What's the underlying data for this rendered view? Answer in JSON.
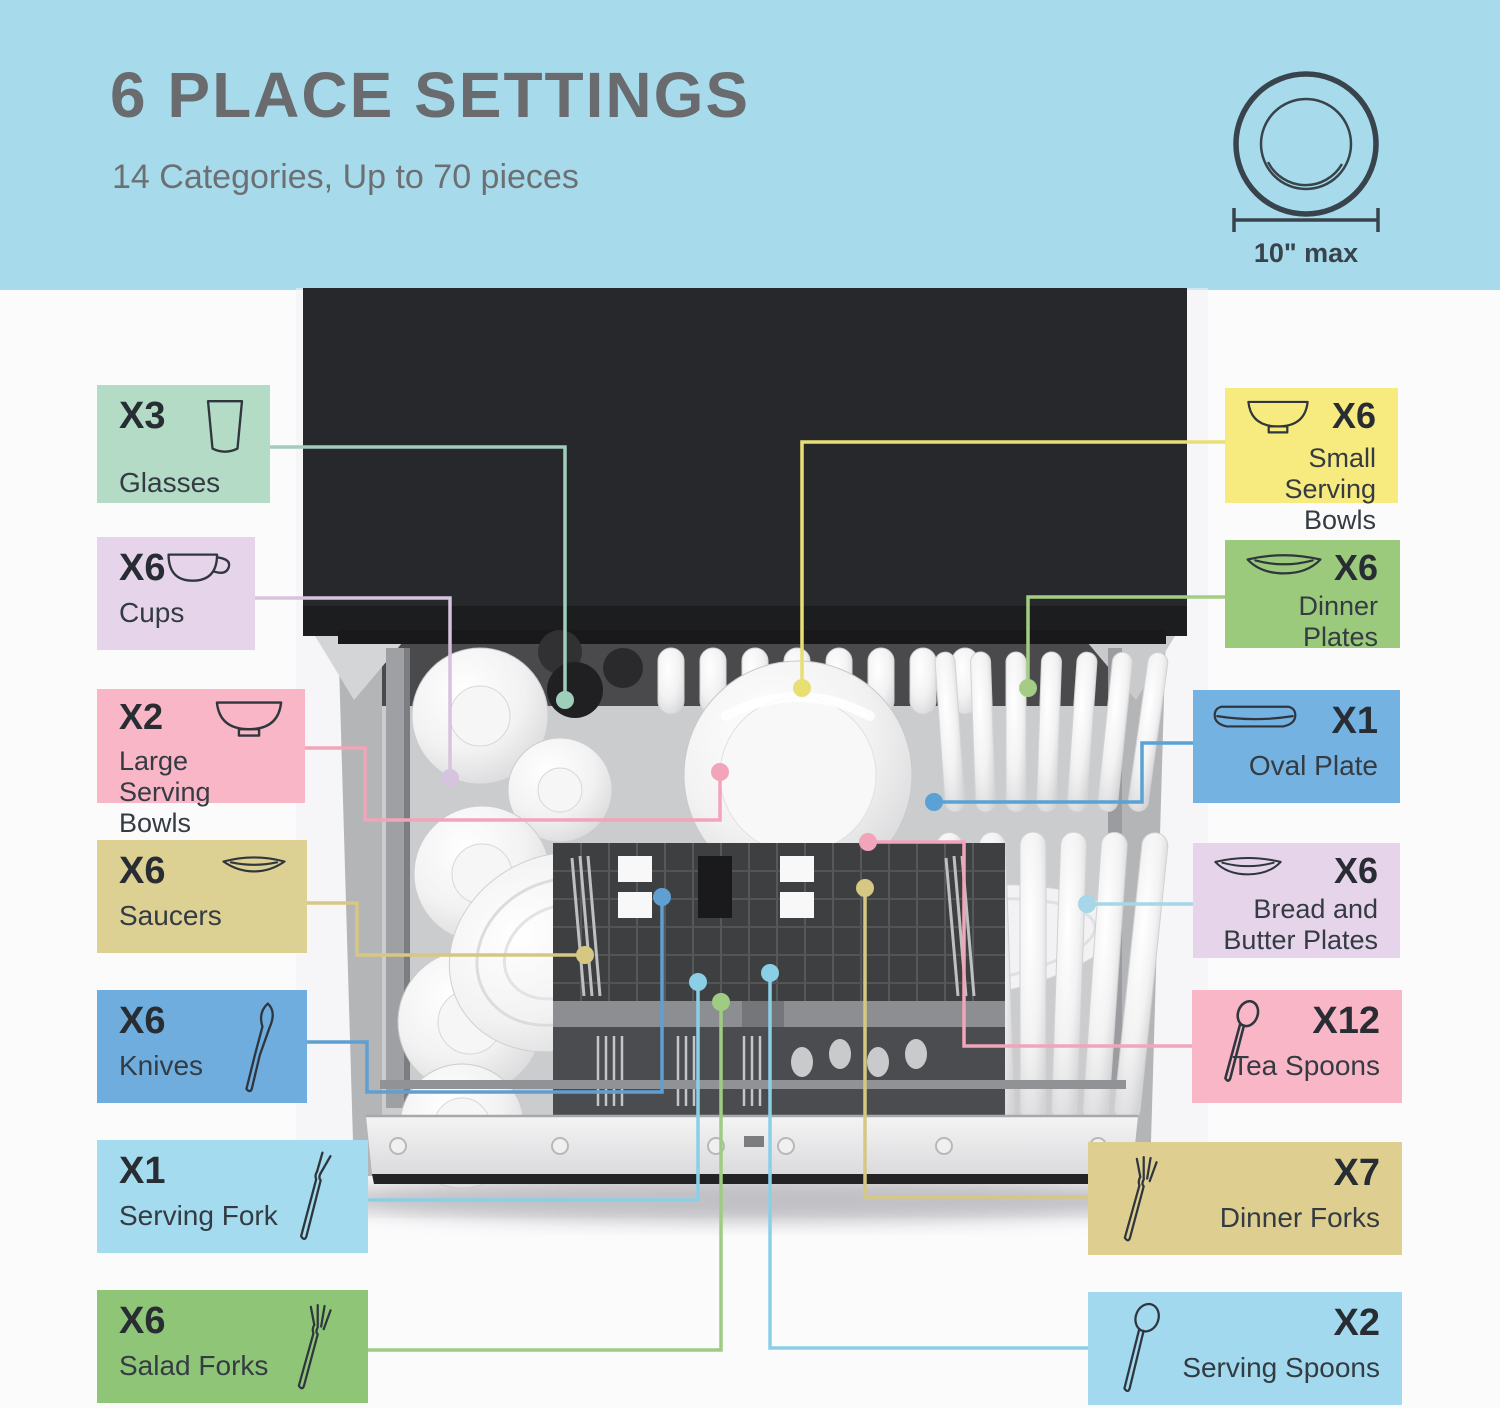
{
  "header": {
    "title": "6 PLACE SETTINGS",
    "subtitle": "14 Categories, Up to 70 pieces",
    "plate_limit": "10\" max"
  },
  "colors": {
    "header_bg": "#a7dbec",
    "header_text": "#696b6e",
    "badge_stroke": "#39434b",
    "icon_stroke": "#2f363d",
    "door_panel": "#27282b"
  },
  "categories": {
    "left": [
      {
        "count": "X3",
        "name": "Glasses",
        "icon": "glass-icon",
        "bg": "#b3dbc6",
        "line": "#9fceba"
      },
      {
        "count": "X6",
        "name": "Cups",
        "icon": "cup-icon",
        "bg": "#e6d4eb",
        "line": "#d6c3de"
      },
      {
        "count": "X2",
        "name": "Large\nServing Bowls",
        "icon": "bowl-icon",
        "bg": "#f8b6c6",
        "line": "#f2a4ba"
      },
      {
        "count": "X6",
        "name": "Saucers",
        "icon": "saucer-icon",
        "bg": "#ddd093",
        "line": "#d6c883"
      },
      {
        "count": "X6",
        "name": "Knives",
        "icon": "knife-icon",
        "bg": "#6fadde",
        "line": "#609fd2"
      },
      {
        "count": "X1",
        "name": "Serving Fork",
        "icon": "serving-fork-icon",
        "bg": "#a4dbee",
        "line": "#8bcfe7"
      },
      {
        "count": "X6",
        "name": "Salad Forks",
        "icon": "fork-icon",
        "bg": "#8fc577",
        "line": "#a0cb82"
      }
    ],
    "right": [
      {
        "count": "X6",
        "name": "Small\nServing Bowls",
        "icon": "bowl-icon",
        "bg": "#f7ea7e",
        "line": "#e8df74"
      },
      {
        "count": "X6",
        "name": "Dinner Plates",
        "icon": "plate-icon",
        "bg": "#9bca7c",
        "line": "#a3cd85"
      },
      {
        "count": "X1",
        "name": "Oval Plate",
        "icon": "oval-plate-icon",
        "bg": "#74b3e1",
        "line": "#5aa2d5"
      },
      {
        "count": "X6",
        "name": "Bread and\nButter Plates",
        "icon": "plate-icon",
        "bg": "#e6d4eb",
        "line": "#a6d6e8"
      },
      {
        "count": "X12",
        "name": "Tea Spoons",
        "icon": "teaspoon-icon",
        "bg": "#f8b6c6",
        "line": "#f2a4ba"
      },
      {
        "count": "X7",
        "name": "Dinner Forks",
        "icon": "fork-icon",
        "bg": "#decf90",
        "line": "#d6c883"
      },
      {
        "count": "X2",
        "name": "Serving Spoons",
        "icon": "spoon-icon",
        "bg": "#a2d9ee",
        "line": "#8bcfe7"
      }
    ]
  }
}
